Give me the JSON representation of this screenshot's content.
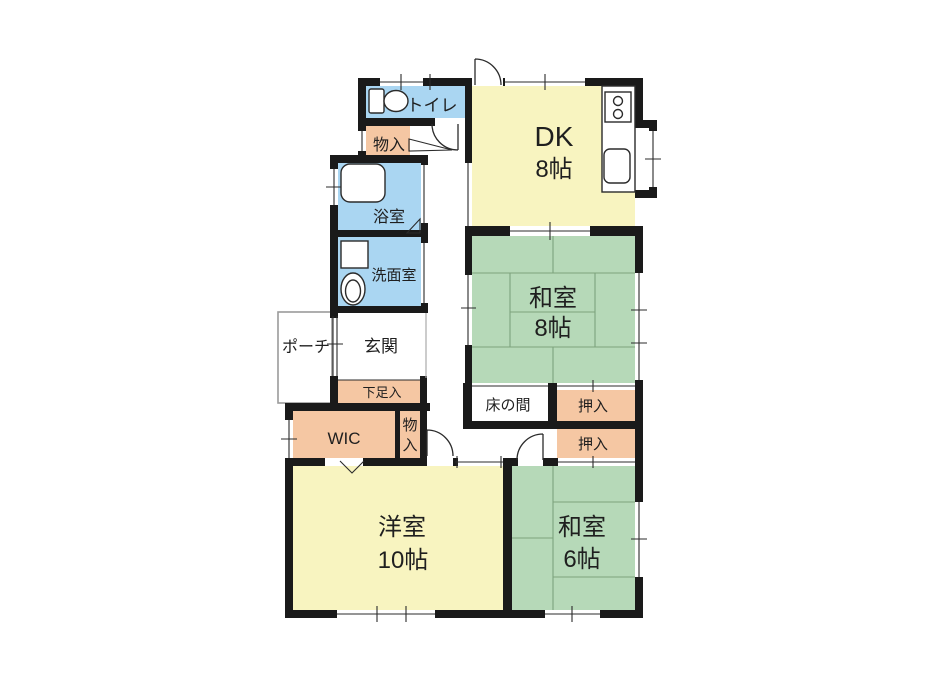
{
  "colors": {
    "wall": "#1a1a1a",
    "line": "#2b2b2b",
    "room_yellow": "#f8f4c0",
    "room_green": "#b6d9b8",
    "room_blue": "#aad6f2",
    "room_salmon": "#f5c7a3",
    "tatami_line": "#7da37d",
    "background": "#ffffff"
  },
  "rooms": {
    "dk": {
      "name": "DK",
      "size": "8帖"
    },
    "washitsu_8": {
      "name": "和室",
      "size": "8帖"
    },
    "washitsu_6": {
      "name": "和室",
      "size": "6帖"
    },
    "yoshitsu_10": {
      "name": "洋室",
      "size": "10帖"
    },
    "toilet": {
      "name": "トイレ"
    },
    "bathroom": {
      "name": "浴室"
    },
    "washroom": {
      "name": "洗面室"
    },
    "entrance": {
      "name": "玄関"
    },
    "porch": {
      "name": "ポーチ"
    },
    "shoe_storage": {
      "name": "下足入"
    },
    "storage_top": {
      "name": "物入"
    },
    "storage_hall": {
      "name": "物入",
      "chars": [
        "物",
        "入"
      ]
    },
    "wic": {
      "name": "WIC"
    },
    "tokonoma": {
      "name": "床の間"
    },
    "oshiire_upper": {
      "name": "押入"
    },
    "oshiire_lower": {
      "name": "押入"
    }
  }
}
